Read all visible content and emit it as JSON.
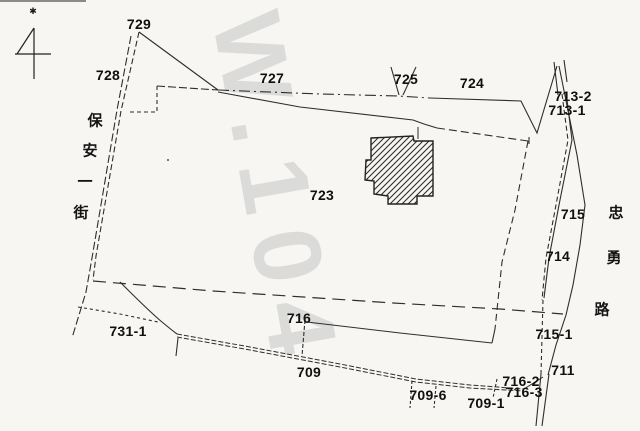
{
  "map": {
    "type": "cadastral-parcel-map",
    "background_color": "#f7f6f3",
    "line_color": "#2e2e2e",
    "label_color": "#101010",
    "watermark": {
      "text": "W.104",
      "color": "#dbdbd9"
    },
    "north_marker": "✱",
    "streets": [
      {
        "name": "保安一街",
        "orientation": "vertical-left",
        "chars": [
          {
            "ch": "保",
            "x": 95,
            "y": 120
          },
          {
            "ch": "安",
            "x": 90,
            "y": 150
          },
          {
            "ch": "一",
            "x": 85,
            "y": 181
          },
          {
            "ch": "街",
            "x": 81,
            "y": 212
          }
        ]
      },
      {
        "name": "忠勇路",
        "orientation": "vertical-right",
        "chars": [
          {
            "ch": "忠",
            "x": 616,
            "y": 212
          },
          {
            "ch": "勇",
            "x": 614,
            "y": 257
          },
          {
            "ch": "路",
            "x": 602,
            "y": 309
          }
        ]
      }
    ],
    "parcels": [
      {
        "id": "729",
        "x": 139,
        "y": 24
      },
      {
        "id": "728",
        "x": 108,
        "y": 75
      },
      {
        "id": "727",
        "x": 272,
        "y": 78
      },
      {
        "id": "725",
        "x": 406,
        "y": 79
      },
      {
        "id": "724",
        "x": 472,
        "y": 83
      },
      {
        "id": "713-2",
        "x": 573,
        "y": 96
      },
      {
        "id": "713-1",
        "x": 567,
        "y": 110
      },
      {
        "id": "723",
        "x": 322,
        "y": 195
      },
      {
        "id": "715",
        "x": 573,
        "y": 214
      },
      {
        "id": "714",
        "x": 558,
        "y": 256
      },
      {
        "id": "715-1",
        "x": 554,
        "y": 334
      },
      {
        "id": "711",
        "x": 563,
        "y": 370
      },
      {
        "id": "716-2",
        "x": 521,
        "y": 381
      },
      {
        "id": "716-3",
        "x": 524,
        "y": 392
      },
      {
        "id": "716",
        "x": 299,
        "y": 318
      },
      {
        "id": "709",
        "x": 309,
        "y": 372
      },
      {
        "id": "709-6",
        "x": 428,
        "y": 395
      },
      {
        "id": "709-1",
        "x": 486,
        "y": 403
      },
      {
        "id": "731-1",
        "x": 128,
        "y": 331
      }
    ]
  }
}
